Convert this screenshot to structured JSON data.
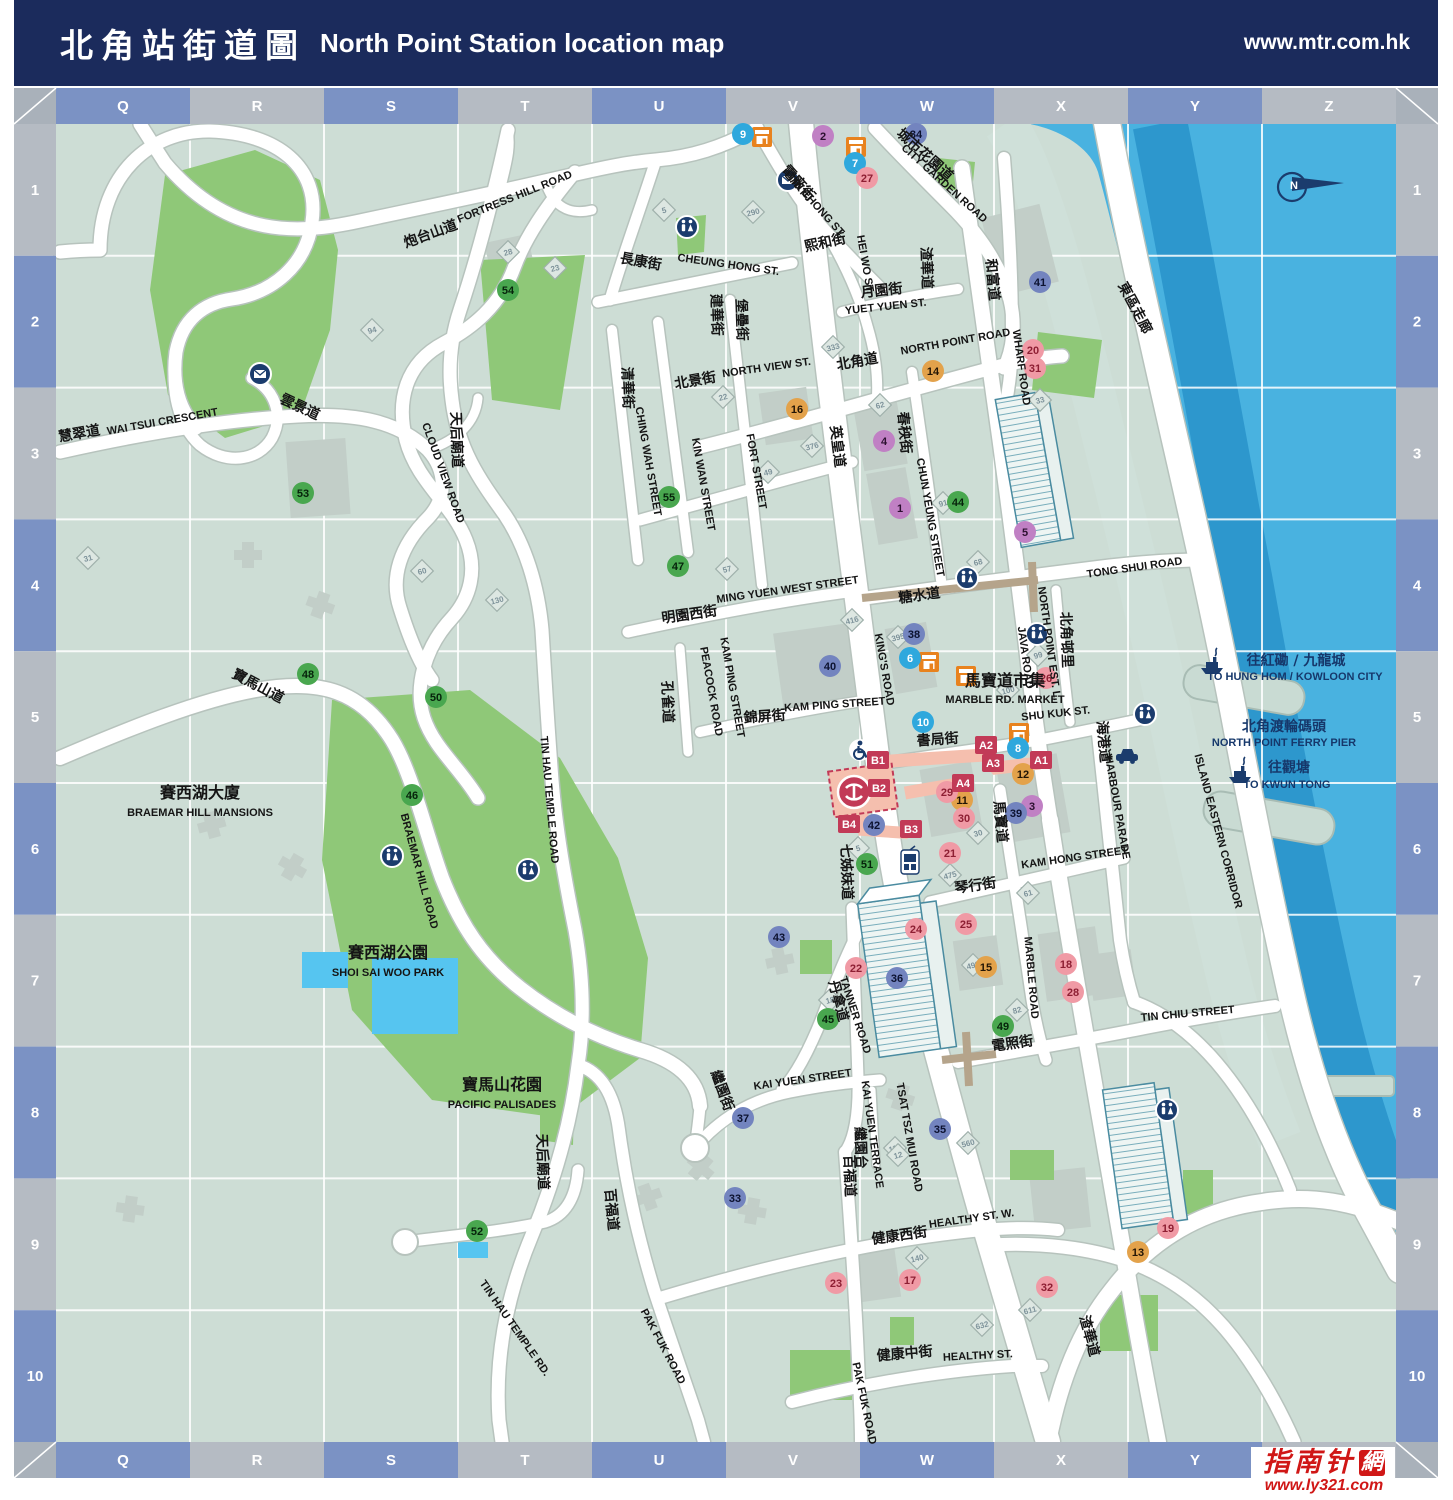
{
  "header": {
    "title_zh": "北角站街道圖",
    "title_en": "North Point Station location map",
    "url": "www.mtr.com.hk"
  },
  "logo": {
    "name_zh": "指南针",
    "seal": "網",
    "url": "www.ly321.com"
  },
  "grid": {
    "cols": [
      "Q",
      "R",
      "S",
      "T",
      "U",
      "V",
      "W",
      "X",
      "Y",
      "Z"
    ],
    "rows": [
      "1",
      "2",
      "3",
      "4",
      "5",
      "6",
      "7",
      "8",
      "9",
      "10"
    ]
  },
  "colors": {
    "header_bg": "#1b2b5c",
    "border_blue": "#7b92c4",
    "border_gray": "#b5bbc3",
    "land": "#cdddd5",
    "water": "#49b2e0",
    "water_dark": "#2d97cd",
    "shore": "#cfe0d9",
    "park": "#8fc878",
    "building": "#c2cec8",
    "road": "#ffffff",
    "road_casing": "#b7c3bd",
    "footbridge": "#b5a48b",
    "station_fill": "#f5bfae",
    "exit": "#c23a57",
    "pool": "#56c5f0",
    "marker_purple": "#c080c4",
    "marker_cyan": "#2fa8dd",
    "marker_orange": "#e3a24b",
    "marker_pink": "#f09aa5",
    "marker_slate": "#7384bf",
    "marker_green": "#49a74f",
    "navy": "#16386b",
    "market_icon": "#e8821e",
    "tower_line": "#4a8ba0"
  },
  "labels": [
    {
      "t": "炮台山道",
      "x": 432,
      "y": 238,
      "r": -20,
      "c": "zh"
    },
    {
      "t": "FORTRESS HILL ROAD",
      "x": 516,
      "y": 200,
      "r": -22,
      "c": "en"
    },
    {
      "t": "慧翠道",
      "x": 80,
      "y": 438,
      "r": -10,
      "c": "zh"
    },
    {
      "t": "WAI TSUI CRESCENT",
      "x": 163,
      "y": 425,
      "r": -10,
      "c": "en"
    },
    {
      "t": "雲景道",
      "x": 298,
      "y": 411,
      "r": 25,
      "c": "zh"
    },
    {
      "t": "CLOUD VIEW ROAD",
      "x": 440,
      "y": 474,
      "r": 70,
      "c": "en"
    },
    {
      "t": "天后廟道",
      "x": 452,
      "y": 440,
      "r": 88,
      "c": "zh"
    },
    {
      "t": "TIN HAU TEMPLE ROAD",
      "x": 546,
      "y": 800,
      "r": 85,
      "c": "en"
    },
    {
      "t": "寶馬山道",
      "x": 256,
      "y": 690,
      "r": 28,
      "c": "zh"
    },
    {
      "t": "BRAEMAR HILL ROAD",
      "x": 416,
      "y": 872,
      "r": 75,
      "c": "en"
    },
    {
      "t": "賽西湖大廈",
      "x": 200,
      "y": 798,
      "r": 0,
      "c": "zhbig"
    },
    {
      "t": "BRAEMAR HILL MANSIONS",
      "x": 200,
      "y": 816,
      "r": 0,
      "c": "en"
    },
    {
      "t": "賽西湖公園",
      "x": 388,
      "y": 958,
      "r": 0,
      "c": "zhbig"
    },
    {
      "t": "SHOI SAI WOO PARK",
      "x": 388,
      "y": 976,
      "r": 0,
      "c": "en"
    },
    {
      "t": "寶馬山花園",
      "x": 502,
      "y": 1090,
      "r": 0,
      "c": "zhbig"
    },
    {
      "t": "PACIFIC PALISADES",
      "x": 502,
      "y": 1108,
      "r": 0,
      "c": "en"
    },
    {
      "t": "天后廟道",
      "x": 538,
      "y": 1162,
      "r": 88,
      "c": "zh"
    },
    {
      "t": "TIN HAU TEMPLE RD.",
      "x": 512,
      "y": 1330,
      "r": 55,
      "c": "en"
    },
    {
      "t": "百福道",
      "x": 607,
      "y": 1210,
      "r": 85,
      "c": "zh"
    },
    {
      "t": "PAK FUK ROAD",
      "x": 660,
      "y": 1348,
      "r": 62,
      "c": "en"
    },
    {
      "t": "百福道",
      "x": 845,
      "y": 1176,
      "r": 88,
      "c": "zh"
    },
    {
      "t": "PAK FUK ROAD",
      "x": 861,
      "y": 1404,
      "r": 78,
      "c": "en"
    },
    {
      "t": "長康街",
      "x": 640,
      "y": 266,
      "r": 10,
      "c": "zh"
    },
    {
      "t": "CHEUNG HONG ST.",
      "x": 728,
      "y": 268,
      "r": 8,
      "c": "en"
    },
    {
      "t": "建華街",
      "x": 712,
      "y": 315,
      "r": 88,
      "c": "zh"
    },
    {
      "t": "KIN WAN STREET",
      "x": 700,
      "y": 485,
      "r": 80,
      "c": "en"
    },
    {
      "t": "清華街",
      "x": 623,
      "y": 388,
      "r": 88,
      "c": "zh"
    },
    {
      "t": "CHING WAH STREET",
      "x": 645,
      "y": 462,
      "r": 80,
      "c": "en"
    },
    {
      "t": "堡壘街",
      "x": 737,
      "y": 320,
      "r": 88,
      "c": "zh"
    },
    {
      "t": "FORT STREET",
      "x": 753,
      "y": 472,
      "r": 80,
      "c": "en"
    },
    {
      "t": "北景街",
      "x": 696,
      "y": 385,
      "r": -10,
      "c": "zh"
    },
    {
      "t": "NORTH VIEW ST.",
      "x": 767,
      "y": 371,
      "r": -8,
      "c": "en"
    },
    {
      "t": "北角道",
      "x": 858,
      "y": 366,
      "r": -10,
      "c": "zh"
    },
    {
      "t": "NORTH POINT ROAD",
      "x": 956,
      "y": 345,
      "r": -10,
      "c": "en"
    },
    {
      "t": "英皇道",
      "x": 833,
      "y": 447,
      "r": 83,
      "c": "zh"
    },
    {
      "t": "KING'S ROAD",
      "x": 881,
      "y": 670,
      "r": 80,
      "c": "en"
    },
    {
      "t": "春秧街",
      "x": 900,
      "y": 433,
      "r": 85,
      "c": "zh"
    },
    {
      "t": "CHUN YEUNG STREET",
      "x": 927,
      "y": 518,
      "r": 80,
      "c": "en"
    },
    {
      "t": "電廠街",
      "x": 795,
      "y": 186,
      "r": 48,
      "c": "zh"
    },
    {
      "t": "TIN CHONG ST.",
      "x": 814,
      "y": 208,
      "r": 48,
      "c": "en"
    },
    {
      "t": "城市花園道",
      "x": 922,
      "y": 158,
      "r": 42,
      "c": "zh"
    },
    {
      "t": "CITY GARDEN ROAD",
      "x": 942,
      "y": 186,
      "r": 42,
      "c": "en"
    },
    {
      "t": "熙和街",
      "x": 826,
      "y": 247,
      "r": -12,
      "c": "zh"
    },
    {
      "t": "HEI WO ST.",
      "x": 862,
      "y": 265,
      "r": 80,
      "c": "en"
    },
    {
      "t": "月園街",
      "x": 882,
      "y": 295,
      "r": -6,
      "c": "zh"
    },
    {
      "t": "YUET YUEN ST.",
      "x": 886,
      "y": 310,
      "r": -6,
      "c": "en"
    },
    {
      "t": "渣華道",
      "x": 922,
      "y": 268,
      "r": 88,
      "c": "zh"
    },
    {
      "t": "和富道",
      "x": 988,
      "y": 280,
      "r": 85,
      "c": "zh"
    },
    {
      "t": "WHARF ROAD",
      "x": 1018,
      "y": 368,
      "r": 82,
      "c": "en"
    },
    {
      "t": "北角邨里",
      "x": 1062,
      "y": 640,
      "r": 88,
      "c": "zh"
    },
    {
      "t": "NORTH POINT EST. L.",
      "x": 1046,
      "y": 644,
      "r": 82,
      "c": "en"
    },
    {
      "t": "JAVA ROAD",
      "x": 1022,
      "y": 658,
      "r": 82,
      "c": "en"
    },
    {
      "t": "糖水道",
      "x": 920,
      "y": 600,
      "r": -8,
      "c": "zh"
    },
    {
      "t": "TONG SHUI ROAD",
      "x": 1135,
      "y": 571,
      "r": -8,
      "c": "en"
    },
    {
      "t": "明園西街",
      "x": 690,
      "y": 619,
      "r": -8,
      "c": "zh"
    },
    {
      "t": "MING YUEN WEST STREET",
      "x": 788,
      "y": 593,
      "r": -8,
      "c": "en"
    },
    {
      "t": "孔雀道",
      "x": 663,
      "y": 702,
      "r": 88,
      "c": "zh"
    },
    {
      "t": "PEACOCK ROAD",
      "x": 708,
      "y": 692,
      "r": 80,
      "c": "en"
    },
    {
      "t": "KAM PING STREET",
      "x": 729,
      "y": 688,
      "r": 80,
      "c": "en"
    },
    {
      "t": "錦屏街",
      "x": 765,
      "y": 721,
      "r": -4,
      "c": "zh"
    },
    {
      "t": "KAM PING STREET",
      "x": 835,
      "y": 708,
      "r": -4,
      "c": "en"
    },
    {
      "t": "書局街",
      "x": 938,
      "y": 744,
      "r": -4,
      "c": "zh"
    },
    {
      "t": "SHU KUK ST.",
      "x": 1056,
      "y": 717,
      "r": -6,
      "c": "en"
    },
    {
      "t": "馬寶道市集",
      "x": 1005,
      "y": 686,
      "r": 0,
      "c": "zhbig"
    },
    {
      "t": "MARBLE RD. MARKET",
      "x": 1005,
      "y": 703,
      "r": 0,
      "c": "en"
    },
    {
      "t": "馬寶道",
      "x": 996,
      "y": 822,
      "r": 85,
      "c": "zh"
    },
    {
      "t": "MARBLE ROAD",
      "x": 1028,
      "y": 978,
      "r": 85,
      "c": "en"
    },
    {
      "t": "海港道",
      "x": 1099,
      "y": 742,
      "r": 85,
      "c": "zh"
    },
    {
      "t": "HARBOUR PARADE",
      "x": 1114,
      "y": 808,
      "r": 80,
      "c": "en"
    },
    {
      "t": "琴行街",
      "x": 976,
      "y": 890,
      "r": -8,
      "c": "zh"
    },
    {
      "t": "KAM HONG STREET",
      "x": 1075,
      "y": 861,
      "r": -8,
      "c": "en"
    },
    {
      "t": "東區走廊",
      "x": 1131,
      "y": 310,
      "r": 62,
      "c": "zh"
    },
    {
      "t": "ISLAND EASTERN CORRIDOR",
      "x": 1215,
      "y": 832,
      "r": 75,
      "c": "en"
    },
    {
      "t": "往紅磡 / 九龍城",
      "x": 1296,
      "y": 665,
      "r": 0,
      "c": "nzh"
    },
    {
      "t": "TO HUNG HOM / KOWLOON CITY",
      "x": 1295,
      "y": 680,
      "r": 0,
      "c": "nen"
    },
    {
      "t": "北角渡輪碼頭",
      "x": 1284,
      "y": 731,
      "r": 0,
      "c": "nzh"
    },
    {
      "t": "NORTH POINT FERRY PIER",
      "x": 1284,
      "y": 746,
      "r": 0,
      "c": "nen"
    },
    {
      "t": "往觀塘",
      "x": 1289,
      "y": 772,
      "r": 0,
      "c": "nzh"
    },
    {
      "t": "TO KWUN TONG",
      "x": 1287,
      "y": 788,
      "r": 0,
      "c": "nen"
    },
    {
      "t": "七姊妹道",
      "x": 842,
      "y": 872,
      "r": 88,
      "c": "zh"
    },
    {
      "t": "丹拿道",
      "x": 834,
      "y": 1002,
      "r": 75,
      "c": "zh"
    },
    {
      "t": "TANNER ROAD",
      "x": 852,
      "y": 1016,
      "r": 72,
      "c": "en"
    },
    {
      "t": "TSAT TSZ MUI ROAD",
      "x": 906,
      "y": 1138,
      "r": 80,
      "c": "en"
    },
    {
      "t": "KAI YUEN STREET",
      "x": 803,
      "y": 1083,
      "r": -8,
      "c": "en"
    },
    {
      "t": "繼園街",
      "x": 718,
      "y": 1092,
      "r": 70,
      "c": "zh"
    },
    {
      "t": "KAI YUEN TERRACE",
      "x": 869,
      "y": 1135,
      "r": 82,
      "c": "en"
    },
    {
      "t": "繼園台",
      "x": 856,
      "y": 1148,
      "r": 88,
      "c": "zh"
    },
    {
      "t": "電照街",
      "x": 1013,
      "y": 1048,
      "r": -8,
      "c": "zh"
    },
    {
      "t": "TIN CHIU STREET",
      "x": 1188,
      "y": 1017,
      "r": -5,
      "c": "en"
    },
    {
      "t": "健康西街",
      "x": 900,
      "y": 1240,
      "r": -8,
      "c": "zh"
    },
    {
      "t": "HEALTHY ST. W.",
      "x": 972,
      "y": 1222,
      "r": -8,
      "c": "en"
    },
    {
      "t": "健康中街",
      "x": 905,
      "y": 1358,
      "r": -5,
      "c": "zh"
    },
    {
      "t": "HEALTHY ST.",
      "x": 978,
      "y": 1359,
      "r": -3,
      "c": "en"
    },
    {
      "t": "渣華道",
      "x": 1085,
      "y": 1337,
      "r": 75,
      "c": "zh"
    }
  ],
  "markers": [
    {
      "n": "1",
      "x": 900,
      "y": 508,
      "c": "purple"
    },
    {
      "n": "2",
      "x": 823,
      "y": 136,
      "c": "purple"
    },
    {
      "n": "3",
      "x": 1032,
      "y": 806,
      "c": "purple"
    },
    {
      "n": "4",
      "x": 884,
      "y": 441,
      "c": "purple"
    },
    {
      "n": "5",
      "x": 1025,
      "y": 532,
      "c": "purple"
    },
    {
      "n": "6",
      "x": 910,
      "y": 658,
      "c": "cyan"
    },
    {
      "n": "7",
      "x": 855,
      "y": 163,
      "c": "cyan"
    },
    {
      "n": "8",
      "x": 1018,
      "y": 748,
      "c": "cyan"
    },
    {
      "n": "9",
      "x": 743,
      "y": 134,
      "c": "cyan"
    },
    {
      "n": "10",
      "x": 923,
      "y": 722,
      "c": "cyan"
    },
    {
      "n": "11",
      "x": 962,
      "y": 800,
      "c": "orange"
    },
    {
      "n": "12",
      "x": 1023,
      "y": 774,
      "c": "orange"
    },
    {
      "n": "13",
      "x": 1138,
      "y": 1252,
      "c": "orange"
    },
    {
      "n": "14",
      "x": 933,
      "y": 371,
      "c": "orange"
    },
    {
      "n": "15",
      "x": 986,
      "y": 967,
      "c": "orange"
    },
    {
      "n": "16",
      "x": 797,
      "y": 409,
      "c": "orange"
    },
    {
      "n": "17",
      "x": 910,
      "y": 1280,
      "c": "pink"
    },
    {
      "n": "18",
      "x": 1066,
      "y": 964,
      "c": "pink"
    },
    {
      "n": "19",
      "x": 1168,
      "y": 1228,
      "c": "pink"
    },
    {
      "n": "20",
      "x": 1033,
      "y": 350,
      "c": "pink"
    },
    {
      "n": "21",
      "x": 950,
      "y": 853,
      "c": "pink"
    },
    {
      "n": "22",
      "x": 856,
      "y": 968,
      "c": "pink"
    },
    {
      "n": "23",
      "x": 836,
      "y": 1283,
      "c": "pink"
    },
    {
      "n": "24",
      "x": 916,
      "y": 929,
      "c": "pink"
    },
    {
      "n": "25",
      "x": 966,
      "y": 924,
      "c": "pink"
    },
    {
      "n": "26",
      "x": 1046,
      "y": 678,
      "c": "pink"
    },
    {
      "n": "27",
      "x": 867,
      "y": 178,
      "c": "pink"
    },
    {
      "n": "28",
      "x": 1073,
      "y": 992,
      "c": "pink"
    },
    {
      "n": "29",
      "x": 947,
      "y": 792,
      "c": "pink"
    },
    {
      "n": "30",
      "x": 964,
      "y": 818,
      "c": "pink"
    },
    {
      "n": "31",
      "x": 1035,
      "y": 368,
      "c": "pink"
    },
    {
      "n": "32",
      "x": 1047,
      "y": 1287,
      "c": "pink"
    },
    {
      "n": "33",
      "x": 735,
      "y": 1198,
      "c": "slate"
    },
    {
      "n": "34",
      "x": 916,
      "y": 134,
      "c": "slate"
    },
    {
      "n": "35",
      "x": 940,
      "y": 1129,
      "c": "slate"
    },
    {
      "n": "36",
      "x": 897,
      "y": 978,
      "c": "slate"
    },
    {
      "n": "37",
      "x": 743,
      "y": 1118,
      "c": "slate"
    },
    {
      "n": "38",
      "x": 914,
      "y": 634,
      "c": "slate"
    },
    {
      "n": "39",
      "x": 1016,
      "y": 813,
      "c": "slate"
    },
    {
      "n": "40",
      "x": 830,
      "y": 666,
      "c": "slate"
    },
    {
      "n": "41",
      "x": 1040,
      "y": 282,
      "c": "slate"
    },
    {
      "n": "42",
      "x": 874,
      "y": 825,
      "c": "slate"
    },
    {
      "n": "43",
      "x": 779,
      "y": 937,
      "c": "slate"
    },
    {
      "n": "44",
      "x": 958,
      "y": 502,
      "c": "green"
    },
    {
      "n": "45",
      "x": 828,
      "y": 1019,
      "c": "green"
    },
    {
      "n": "46",
      "x": 412,
      "y": 795,
      "c": "green"
    },
    {
      "n": "47",
      "x": 678,
      "y": 566,
      "c": "green"
    },
    {
      "n": "48",
      "x": 308,
      "y": 674,
      "c": "green"
    },
    {
      "n": "49",
      "x": 1003,
      "y": 1026,
      "c": "green"
    },
    {
      "n": "50",
      "x": 436,
      "y": 697,
      "c": "green"
    },
    {
      "n": "51",
      "x": 867,
      "y": 864,
      "c": "green"
    },
    {
      "n": "52",
      "x": 477,
      "y": 1231,
      "c": "green"
    },
    {
      "n": "53",
      "x": 303,
      "y": 493,
      "c": "green"
    },
    {
      "n": "54",
      "x": 508,
      "y": 290,
      "c": "green"
    },
    {
      "n": "55",
      "x": 669,
      "y": 497,
      "c": "green"
    }
  ],
  "exits": [
    {
      "t": "A1",
      "x": 1041,
      "y": 760
    },
    {
      "t": "A2",
      "x": 986,
      "y": 745
    },
    {
      "t": "A3",
      "x": 993,
      "y": 763
    },
    {
      "t": "A4",
      "x": 963,
      "y": 783
    },
    {
      "t": "B1",
      "x": 878,
      "y": 760
    },
    {
      "t": "B2",
      "x": 879,
      "y": 788
    },
    {
      "t": "B3",
      "x": 911,
      "y": 829
    },
    {
      "t": "B4",
      "x": 849,
      "y": 824
    }
  ],
  "badges": [
    {
      "n": "5",
      "x": 664,
      "y": 210
    },
    {
      "n": "28",
      "x": 508,
      "y": 252
    },
    {
      "n": "23",
      "x": 555,
      "y": 268
    },
    {
      "n": "94",
      "x": 372,
      "y": 330
    },
    {
      "n": "31",
      "x": 88,
      "y": 558
    },
    {
      "n": "60",
      "x": 422,
      "y": 571
    },
    {
      "n": "130",
      "x": 497,
      "y": 600
    },
    {
      "n": "290",
      "x": 753,
      "y": 212
    },
    {
      "n": "333",
      "x": 833,
      "y": 347
    },
    {
      "n": "376",
      "x": 812,
      "y": 446
    },
    {
      "n": "22",
      "x": 723,
      "y": 397
    },
    {
      "n": "49",
      "x": 768,
      "y": 472
    },
    {
      "n": "57",
      "x": 727,
      "y": 569
    },
    {
      "n": "62",
      "x": 880,
      "y": 405
    },
    {
      "n": "91",
      "x": 943,
      "y": 503
    },
    {
      "n": "68",
      "x": 978,
      "y": 562
    },
    {
      "n": "33",
      "x": 1040,
      "y": 400
    },
    {
      "n": "416",
      "x": 852,
      "y": 620
    },
    {
      "n": "395",
      "x": 898,
      "y": 637
    },
    {
      "n": "99",
      "x": 1038,
      "y": 655
    },
    {
      "n": "100",
      "x": 1008,
      "y": 690
    },
    {
      "n": "5",
      "x": 858,
      "y": 848
    },
    {
      "n": "475",
      "x": 950,
      "y": 875
    },
    {
      "n": "30",
      "x": 978,
      "y": 833
    },
    {
      "n": "61",
      "x": 1028,
      "y": 893
    },
    {
      "n": "18",
      "x": 830,
      "y": 1000
    },
    {
      "n": "499",
      "x": 973,
      "y": 965
    },
    {
      "n": "82",
      "x": 1017,
      "y": 1010
    },
    {
      "n": "560",
      "x": 968,
      "y": 1143
    },
    {
      "n": "112",
      "x": 895,
      "y": 1148
    },
    {
      "n": "140",
      "x": 917,
      "y": 1258
    },
    {
      "n": "632",
      "x": 982,
      "y": 1325
    },
    {
      "n": "611",
      "x": 1030,
      "y": 1310
    },
    {
      "n": "12",
      "x": 898,
      "y": 1155
    }
  ],
  "icons": [
    {
      "t": "mtr",
      "x": 854,
      "y": 792
    },
    {
      "t": "wheelchair",
      "x": 860,
      "y": 750
    },
    {
      "t": "tram",
      "x": 910,
      "y": 861
    },
    {
      "t": "taxi",
      "x": 1127,
      "y": 757
    },
    {
      "t": "north",
      "x": 1292,
      "y": 187
    },
    {
      "t": "post",
      "x": 788,
      "y": 180
    },
    {
      "t": "post",
      "x": 260,
      "y": 374
    },
    {
      "t": "wc",
      "x": 687,
      "y": 227
    },
    {
      "t": "wc",
      "x": 392,
      "y": 856
    },
    {
      "t": "wc",
      "x": 528,
      "y": 870
    },
    {
      "t": "wc",
      "x": 967,
      "y": 578
    },
    {
      "t": "wc",
      "x": 1037,
      "y": 634
    },
    {
      "t": "wc",
      "x": 1145,
      "y": 714
    },
    {
      "t": "wc",
      "x": 1167,
      "y": 1110
    },
    {
      "t": "ferry",
      "x": 1212,
      "y": 665
    },
    {
      "t": "ferry",
      "x": 1240,
      "y": 774
    },
    {
      "t": "market",
      "x": 762,
      "y": 137
    },
    {
      "t": "market",
      "x": 856,
      "y": 147
    },
    {
      "t": "market",
      "x": 929,
      "y": 662
    },
    {
      "t": "market",
      "x": 966,
      "y": 676
    },
    {
      "t": "market",
      "x": 1019,
      "y": 733
    }
  ]
}
